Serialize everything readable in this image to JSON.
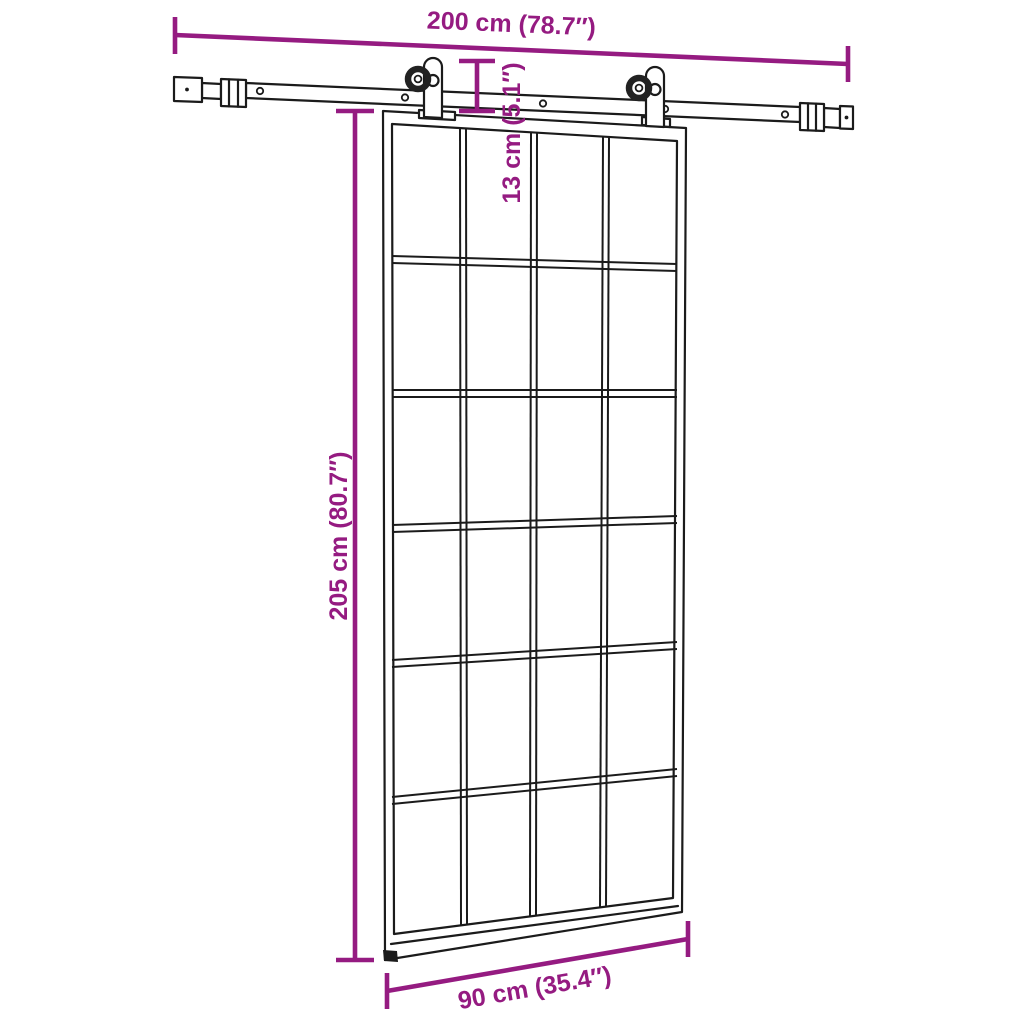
{
  "diagram": {
    "subject": "sliding-door-with-hardware-kit",
    "colors": {
      "dimension_accent": "#951b81",
      "outline": "#1b1b1b",
      "background": "#ffffff"
    },
    "door": {
      "grid_columns": 4,
      "grid_rows": 6
    },
    "dimensions": {
      "track_length": {
        "label": "200 cm (78.7″)",
        "cm": "200 cm",
        "inches": "78.7″"
      },
      "hanger_height": {
        "label": "13 cm (5.1″)",
        "cm": "13 cm",
        "inches": "5.1″"
      },
      "door_height": {
        "label": "205 cm (80.7″)",
        "cm": "205 cm",
        "inches": "80.7″"
      },
      "door_width": {
        "label": "90 cm (35.4″)",
        "cm": "90 cm",
        "inches": "35.4″"
      }
    }
  }
}
